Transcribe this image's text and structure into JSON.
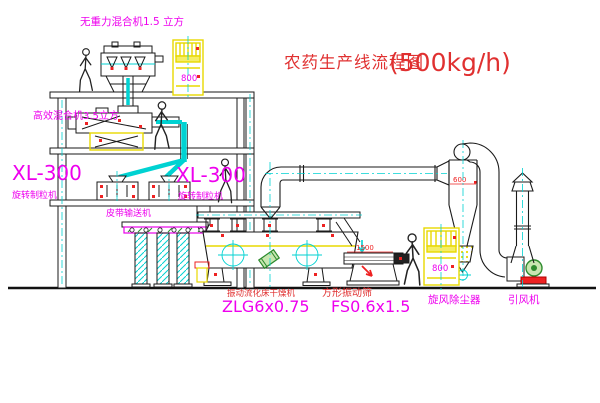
{
  "title": {
    "name_cn": "农药生产线流程图",
    "capacity": "(500kg/h)"
  },
  "labels": {
    "top_mixer": "无重力混合机1.5 立方",
    "floor2_mixer": "高效混合机3.5立方",
    "granulator_left_model": "XL-300",
    "granulator_left_name": "旋转制粒机",
    "granulator_mid_model": "XL-300",
    "granulator_mid_name": "旋转制粒机",
    "belt_conveyor": "皮带输送机",
    "dryer_name": "振动流化床干燥机",
    "dryer_model": "ZLG6x0.75",
    "sieve_name": "方形振动筛",
    "sieve_model": "FS0.6x1.5",
    "cyclone": "旋风除尘器",
    "fan": "引风机"
  },
  "dimensions": {
    "elevator1": "800",
    "elevator2": "800",
    "cyclone_inlet": "600",
    "sieve_length": "1500"
  },
  "colors": {
    "line_black": "#1a1a1a",
    "centerline_cyan": "#00d2d2",
    "equipment_yellow": "#e8d800",
    "text_magenta": "#ee00ee",
    "text_red": "#e03030",
    "dim_red": "#ee2222",
    "detail_green": "#2e8b2e",
    "belt_magenta": "#e800e8"
  }
}
